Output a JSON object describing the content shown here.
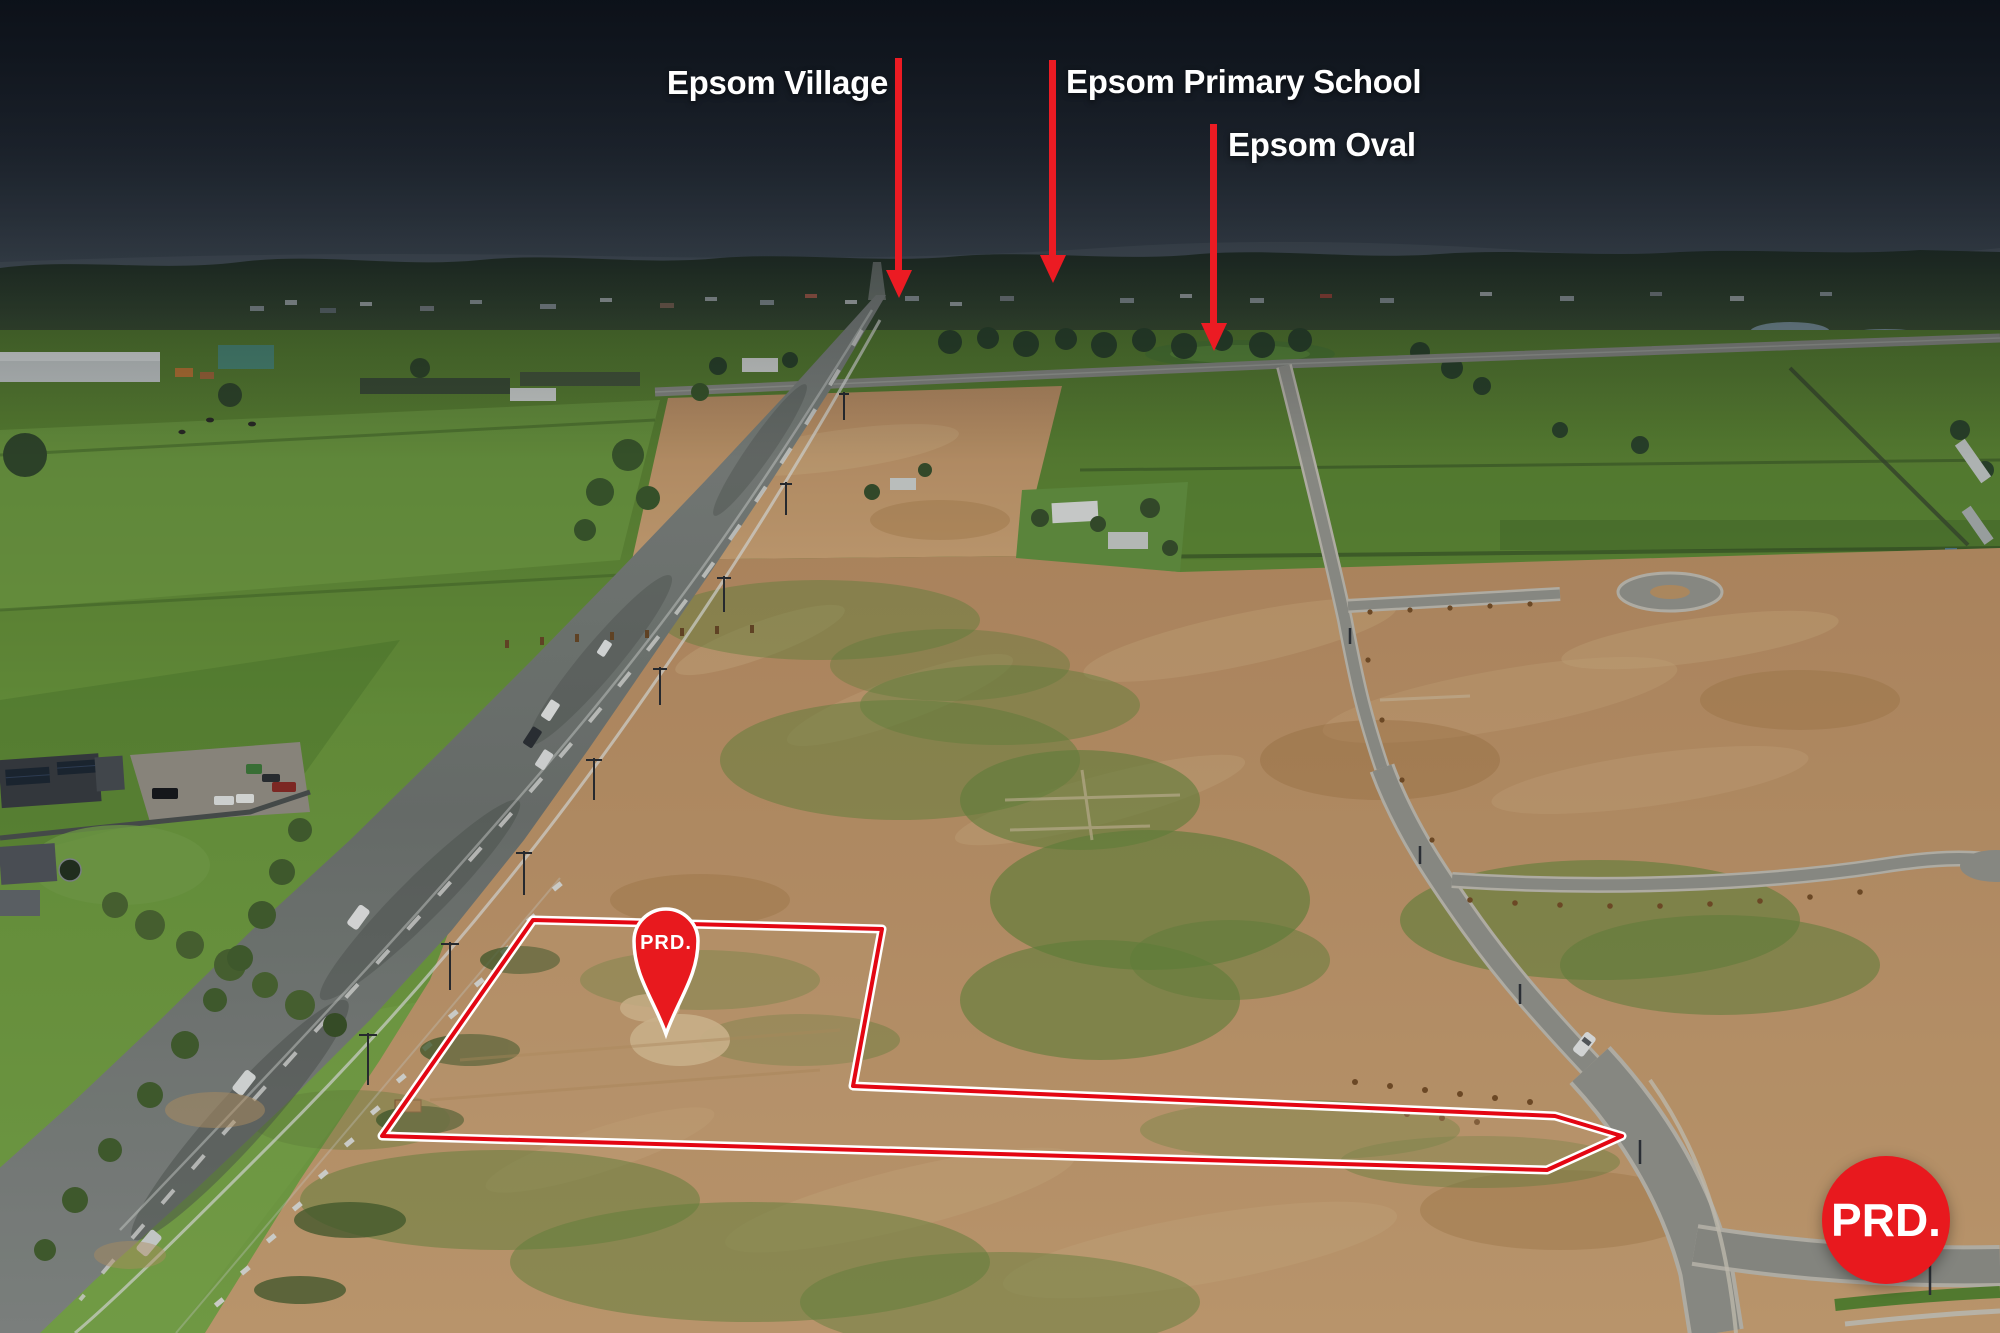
{
  "annotations": {
    "labels": [
      {
        "id": "epsom-village",
        "text": "Epsom Village"
      },
      {
        "id": "epsom-primary-school",
        "text": "Epsom Primary School"
      },
      {
        "id": "epsom-oval",
        "text": "Epsom Oval"
      }
    ]
  },
  "pin": {
    "label": "PRD."
  },
  "logo": {
    "text": "PRD."
  },
  "colors": {
    "annotation_red": "#ec1b23",
    "boundary_red": "#e30613",
    "pin_red": "#e8191e",
    "logo_red": "#e8191e",
    "label_text": "#ffffff"
  }
}
